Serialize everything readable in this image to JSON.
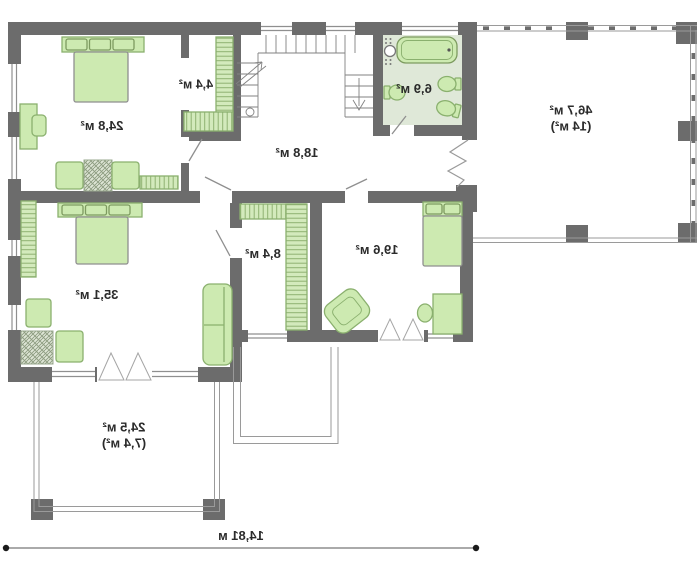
{
  "type": "floor-plan",
  "text_is_mirrored": true,
  "rooms": [
    {
      "name": "bedroom-top-left",
      "area_label": "24,8 м²"
    },
    {
      "name": "walk-in-wardrobe",
      "area_label": "4,4 м²"
    },
    {
      "name": "hall-staircase",
      "area_label": "18,8 м²"
    },
    {
      "name": "bathroom",
      "area_label": "6,9 м²"
    },
    {
      "name": "side-terrace",
      "area_label": "46,7 м²",
      "area_note": "(14 м²)"
    },
    {
      "name": "bedroom-middle-left",
      "area_label": "35,1 м²"
    },
    {
      "name": "walk-in-closet",
      "area_label": "8,4 м²"
    },
    {
      "name": "bedroom-bottom-right",
      "area_label": "19,6 м²"
    },
    {
      "name": "front-terrace",
      "area_label": "24,5 м²",
      "area_note": "(7,4 м²)"
    }
  ],
  "dimension_line": {
    "label": "14,81 м"
  },
  "colors": {
    "wall": "#6c6c6c",
    "furniture_fill": "#cdeab1",
    "furniture_border": "#8ab06e",
    "hatch_line": "#8fb271",
    "bathroom_floor": "#dfe8d8",
    "thin_line": "#9a9a9a",
    "label_text": "#2b2b2b"
  }
}
